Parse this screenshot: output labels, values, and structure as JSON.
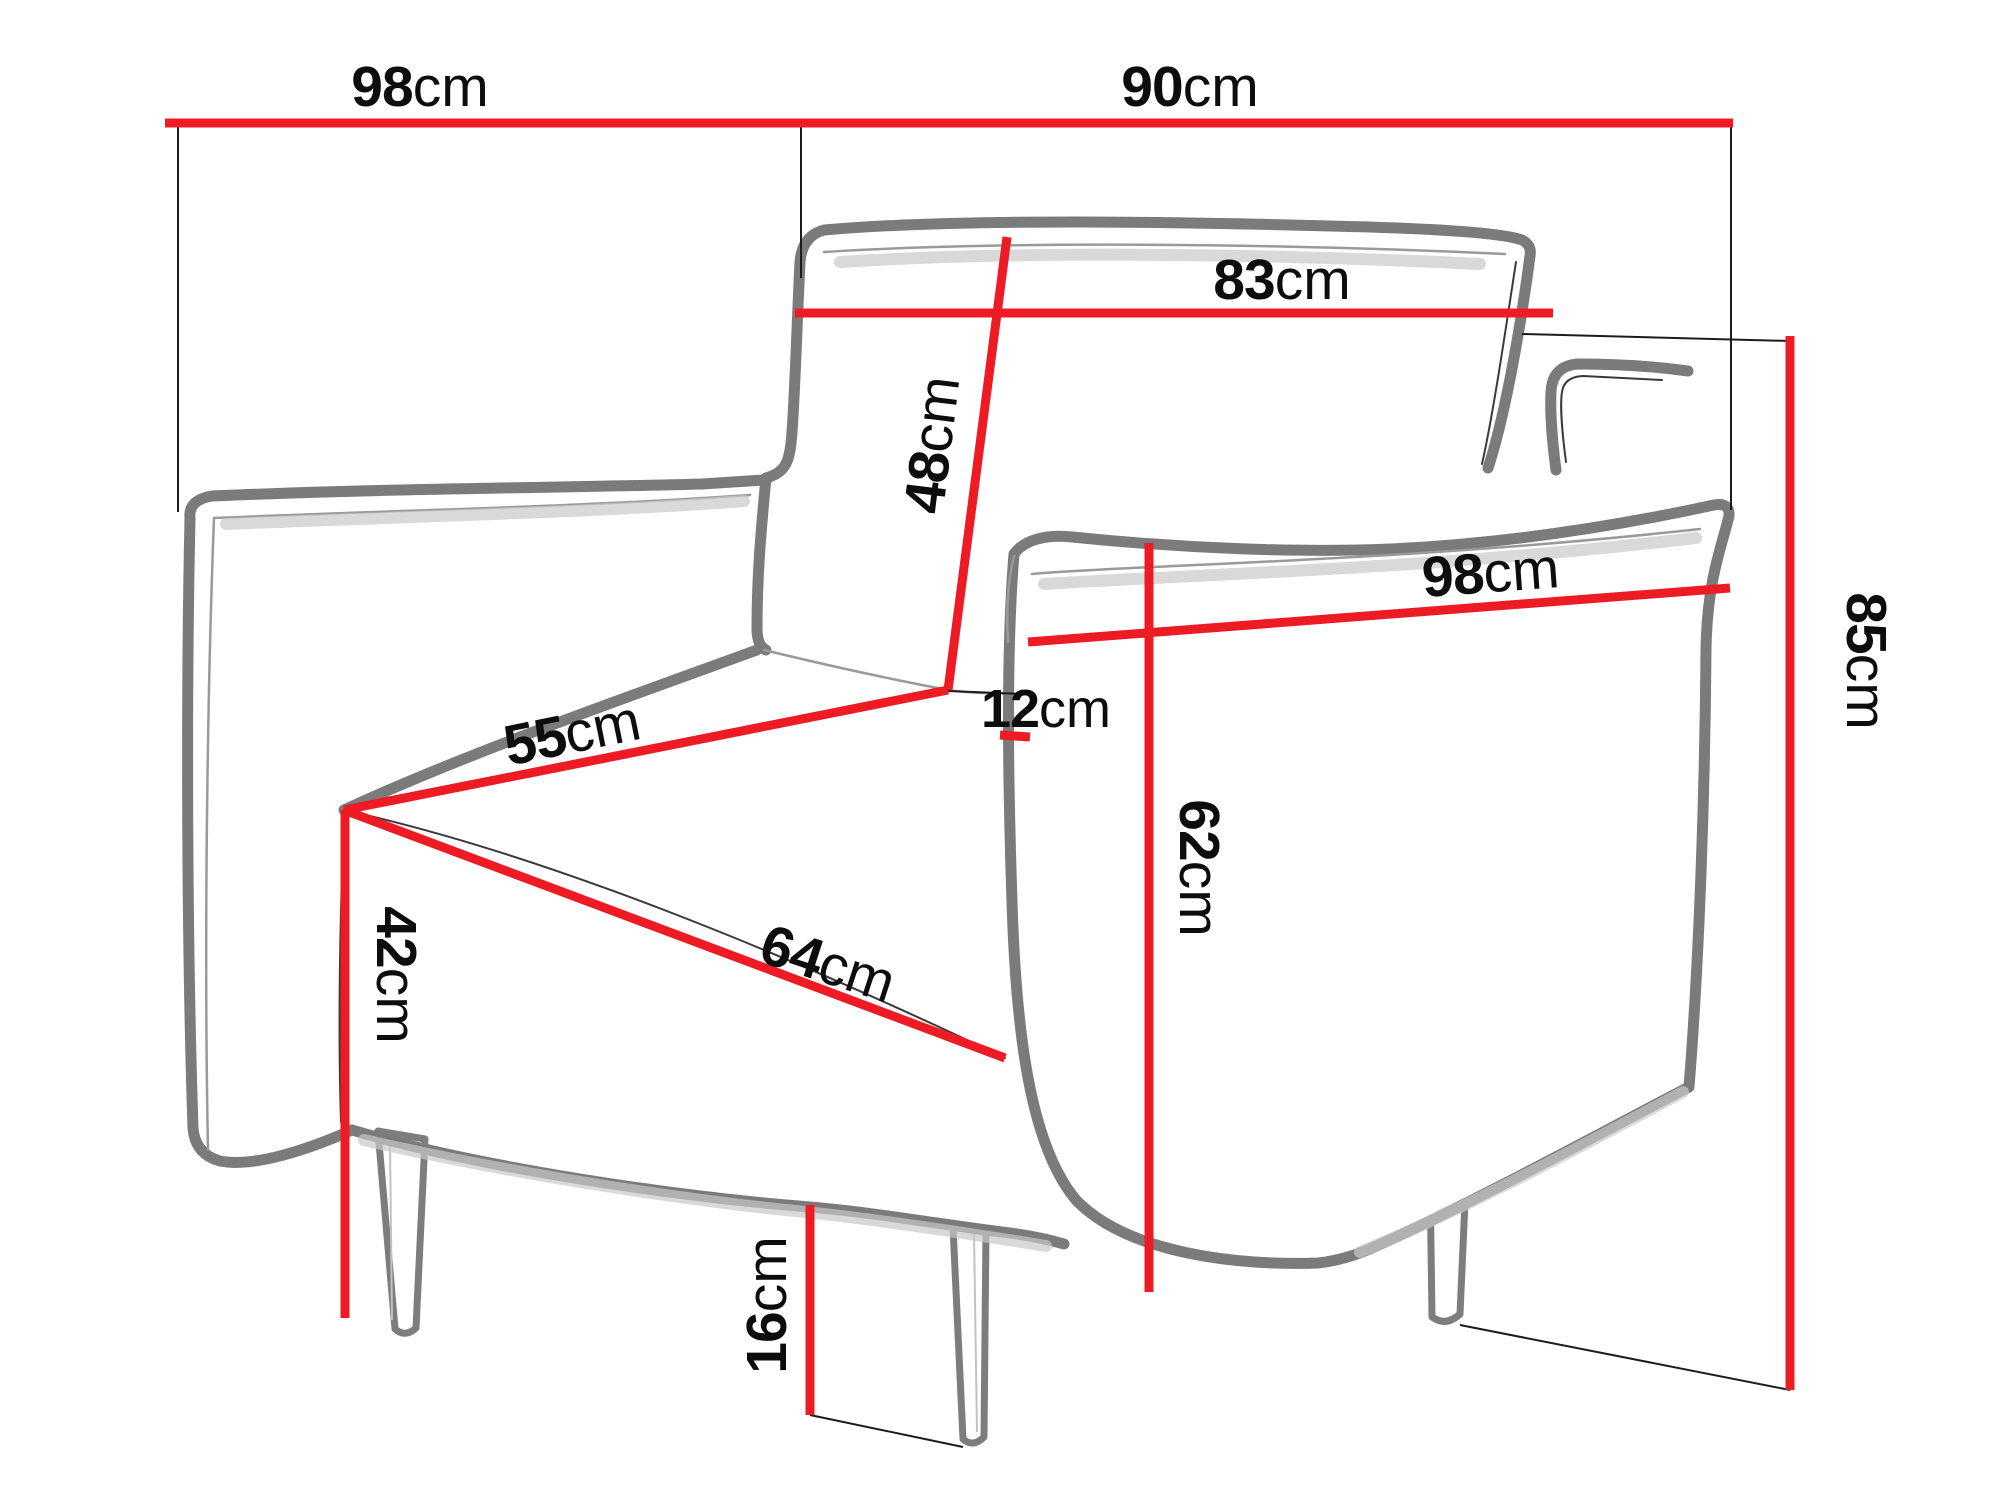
{
  "figure": {
    "type": "furniture-dimension-diagram",
    "subject": "armchair line drawing with measurement lines",
    "background": "#ffffff"
  },
  "colors": {
    "dimension_line": "#ed1c24",
    "chair_outline": "#7b7b7b",
    "label_text": "#0d0d0d",
    "reference_line": "#1c1c1c"
  },
  "unit": "cm",
  "measurements": {
    "back_width": {
      "value": "98",
      "unit": "cm",
      "orientation": "horizontal-top-left"
    },
    "side_depth": {
      "value": "90",
      "unit": "cm",
      "orientation": "horizontal-top-right"
    },
    "backrest_width": {
      "value": "83",
      "unit": "cm",
      "orientation": "horizontal-on-backrest"
    },
    "backrest_height": {
      "value": "48",
      "unit": "cm",
      "orientation": "vertical-along-backrest"
    },
    "armrest_length": {
      "value": "98",
      "unit": "cm",
      "orientation": "horizontal-on-armrest"
    },
    "total_height": {
      "value": "85",
      "unit": "cm",
      "orientation": "vertical-right"
    },
    "seat_depth": {
      "value": "55",
      "unit": "cm",
      "orientation": "diagonal-seat-left"
    },
    "armrest_thickness": {
      "value": "12",
      "unit": "cm",
      "orientation": "vertical-small-front"
    },
    "seat_width": {
      "value": "64",
      "unit": "cm",
      "orientation": "diagonal-seat-front"
    },
    "armrest_height": {
      "value": "62",
      "unit": "cm",
      "orientation": "vertical-center"
    },
    "seat_height": {
      "value": "42",
      "unit": "cm",
      "orientation": "vertical-front-left"
    },
    "leg_height": {
      "value": "16",
      "unit": "cm",
      "orientation": "vertical-bottom"
    }
  }
}
